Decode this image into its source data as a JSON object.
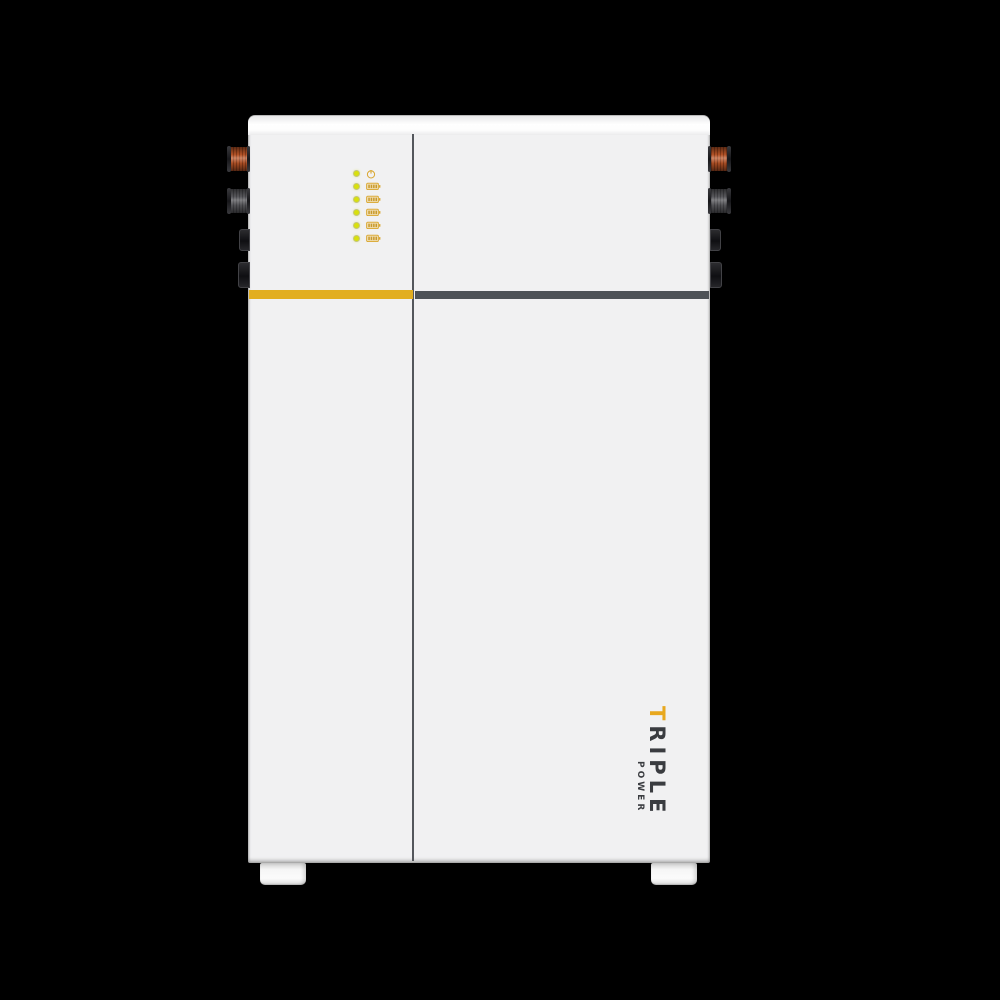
{
  "scene": {
    "type": "product-photo",
    "subject": "wall-mounted home battery energy storage unit, front view",
    "background_color": "#000000"
  },
  "device": {
    "body_color": "#F1F1F2",
    "top_band_color": "#FFFFFF",
    "divider_color": "#54575C",
    "accent_stripe_color": "#E2AE20",
    "dark_stripe_color": "#4E5257"
  },
  "branding": {
    "line1_accent": "T",
    "line1_rest": "RIPLE",
    "line2": "POWER",
    "accent_color": "#E8A81E",
    "text_color": "#3A3C40",
    "orientation": "rotated-90-clockwise"
  },
  "led_panel": {
    "led_color": "#D8E00D",
    "icon_color": "#D9A62E",
    "indicators": [
      {
        "icon": "power-icon",
        "label": "power-status"
      },
      {
        "icon": "battery-icon",
        "label": "battery-level-1"
      },
      {
        "icon": "battery-icon",
        "label": "battery-level-2"
      },
      {
        "icon": "battery-icon",
        "label": "battery-level-3"
      },
      {
        "icon": "battery-icon",
        "label": "battery-level-4"
      },
      {
        "icon": "battery-icon",
        "label": "battery-level-5"
      }
    ]
  },
  "connectors": {
    "left": [
      {
        "type": "dc-plug",
        "color": "#BC5628",
        "shape": "cylinder"
      },
      {
        "type": "dc-plug",
        "color": "#5C5C60",
        "shape": "cylinder"
      },
      {
        "type": "port",
        "color": "#1C1C1E",
        "shape": "box"
      },
      {
        "type": "port",
        "color": "#1C1C1E",
        "shape": "box"
      }
    ],
    "right": [
      {
        "type": "dc-plug",
        "color": "#BC5628",
        "shape": "cylinder"
      },
      {
        "type": "dc-plug",
        "color": "#5C5C60",
        "shape": "cylinder"
      },
      {
        "type": "port",
        "color": "#1C1C1E",
        "shape": "box"
      },
      {
        "type": "port",
        "color": "#1C1C1E",
        "shape": "box"
      }
    ]
  },
  "feet": {
    "count": 2,
    "color": "#F6F6F6"
  }
}
